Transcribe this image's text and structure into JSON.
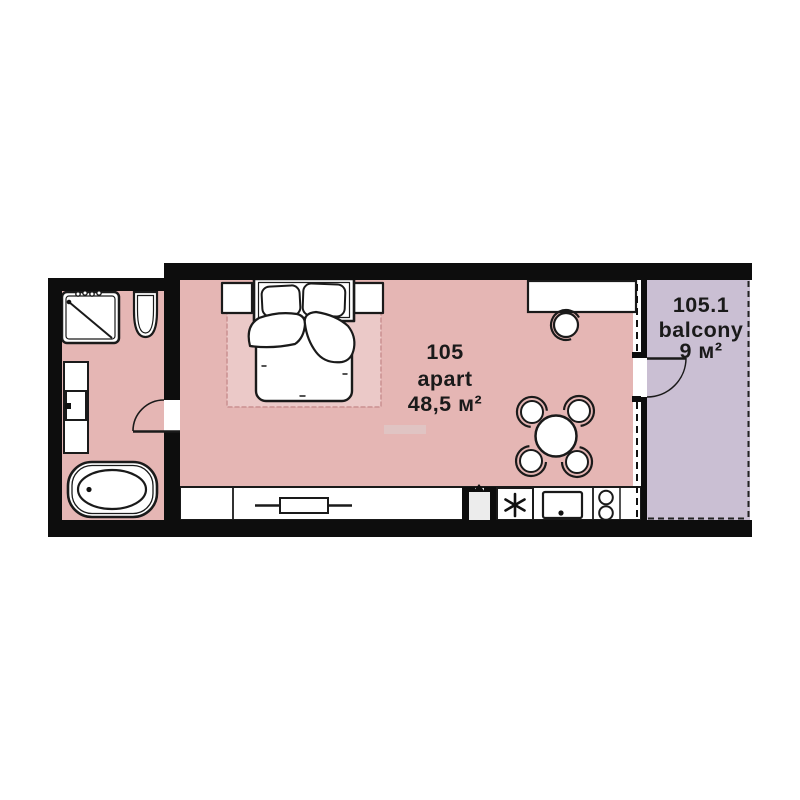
{
  "plan_title": "apartment floor plan",
  "apartment": {
    "number": "105",
    "type_label": "apart",
    "area": "48,5 м²"
  },
  "balcony": {
    "number": "105.1",
    "type_label": "balcony",
    "area": "9 м²"
  },
  "colors": {
    "room_fill": "#e5b6b4",
    "rug_fill": "#eccbca",
    "balcony_fill": "#cabfd3",
    "wall": "#0d0d0d",
    "line": "#1a1a1a",
    "text": "#1a1a1a"
  },
  "fixtures": [
    "shower",
    "toilet",
    "vanity-sink",
    "bathtub",
    "bathroom-door",
    "double-bed",
    "nightstand-left",
    "nightstand-right",
    "rug",
    "desk",
    "stool",
    "dining-table",
    "dining-chairs",
    "wardrobe-sliding",
    "entrance-door",
    "fridge",
    "kitchen-sink",
    "stove",
    "window",
    "balcony-door"
  ]
}
